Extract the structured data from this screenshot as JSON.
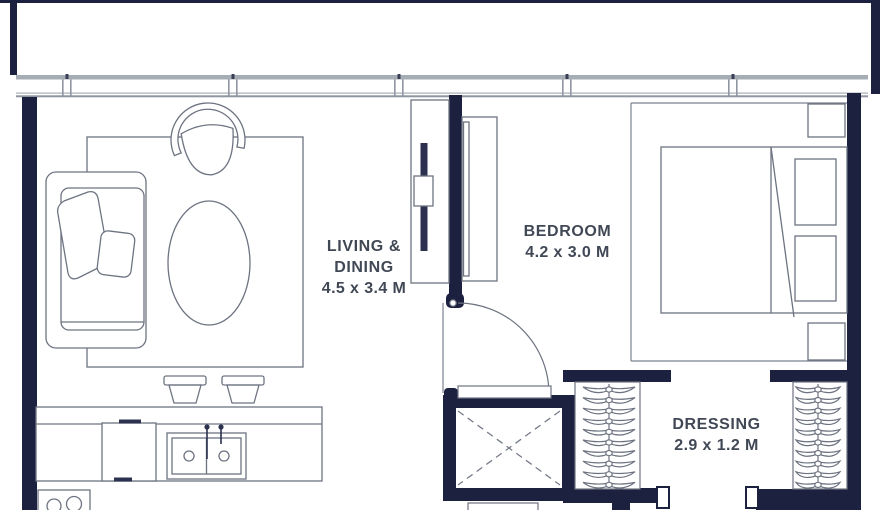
{
  "title": "Apartment floor plan",
  "rooms": [
    {
      "id": "living-dining",
      "name_line1": "LIVING &",
      "name_line2": "DINING",
      "dimensions": "4.5 x 3.4 M"
    },
    {
      "id": "bedroom",
      "name": "BEDROOM",
      "dimensions": "4.2 x 3.0 M"
    },
    {
      "id": "dressing",
      "name": "DRESSING",
      "dimensions": "2.9 x 1.2 M"
    }
  ],
  "colors": {
    "wall": "#1d2140",
    "line": "#6d7380",
    "window": "#a7adb5",
    "window_dark": "#8f96a1",
    "text": "#414855",
    "background": "#ffffff"
  }
}
